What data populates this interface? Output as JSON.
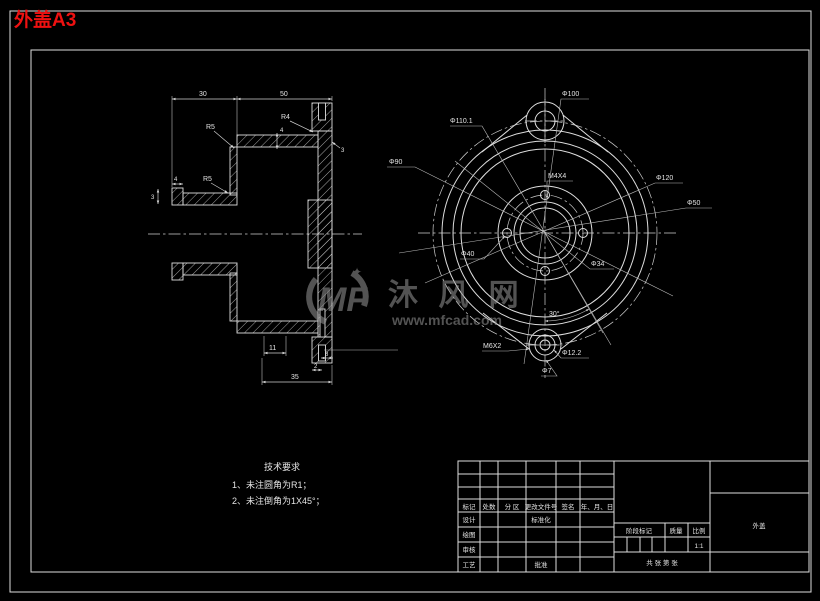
{
  "page": {
    "title": "外盖A3"
  },
  "colors": {
    "background": "#000000",
    "line": "#dedede",
    "title_red": "#ee1111",
    "watermark_gray": "#989898"
  },
  "watermark": {
    "logo": "MF",
    "brand": "沐 风 网",
    "url": "www.mfcad.com",
    "sparkle": "✦"
  },
  "section_view": {
    "dims": {
      "d30": "30",
      "d50": "50",
      "r4": "R4",
      "r5a": "R5",
      "r5b": "R5",
      "d4": "4",
      "d3": "3",
      "d4b": "4",
      "d3b": "3",
      "d11": "11",
      "d35": "35",
      "d8": "8",
      "d2": "2"
    }
  },
  "front_view": {
    "labels": {
      "d110": "Φ110.1",
      "d100": "Φ100",
      "d120": "Φ120",
      "d90": "Φ90",
      "d50": "Φ50",
      "d40": "Φ40",
      "d34": "Φ34",
      "m4": "M4X4",
      "m6": "M6X2",
      "d122": "Φ12.2",
      "d7": "Φ7",
      "a30": "30°"
    }
  },
  "tech_req": {
    "title": "技术要求",
    "item1": "1、未注圆角为R1；",
    "item2": "2、未注倒角为1X45°；"
  },
  "title_block": {
    "header": {
      "c1": "标记",
      "c2": "处数",
      "c3": "分 区",
      "c4": "更改文件号",
      "c5": "签名",
      "c6": "年、月、日"
    },
    "rows": {
      "r1": "设计",
      "r2": "绘图",
      "r3": "审核",
      "r4": "工艺"
    },
    "std": "标准化",
    "approve": "批准",
    "stage": "阶段标记",
    "mass": "质量",
    "scale_label": "比例",
    "scale": "1:1",
    "sheet": "共  张  第  张",
    "part_name": "外盖"
  }
}
